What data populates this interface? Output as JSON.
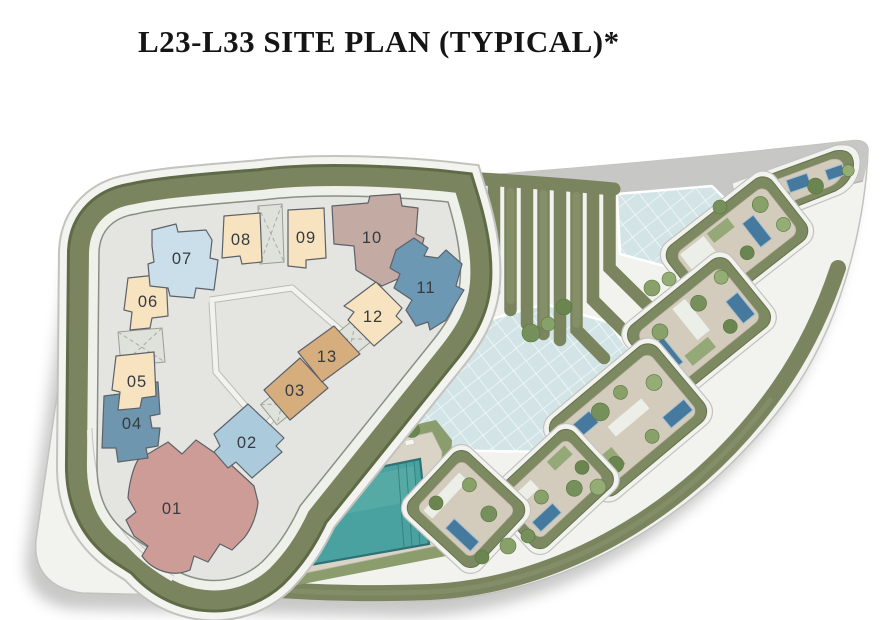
{
  "title": "L23-L33 SITE PLAN (TYPICAL)*",
  "units": [
    {
      "id": "unit-01",
      "label": "01",
      "color": "#cd9c97"
    },
    {
      "id": "unit-02",
      "label": "02",
      "color": "#abcbdc"
    },
    {
      "id": "unit-03",
      "label": "03",
      "color": "#d6ad7c"
    },
    {
      "id": "unit-04",
      "label": "04",
      "color": "#6e96ae"
    },
    {
      "id": "unit-05",
      "label": "05",
      "color": "#f7e3bf"
    },
    {
      "id": "unit-06",
      "label": "06",
      "color": "#f7e3bf"
    },
    {
      "id": "unit-07",
      "label": "07",
      "color": "#cadfe9"
    },
    {
      "id": "unit-08",
      "label": "08",
      "color": "#f7e3bf"
    },
    {
      "id": "unit-09",
      "label": "09",
      "color": "#f7e3bf"
    },
    {
      "id": "unit-10",
      "label": "10",
      "color": "#c3aba3"
    },
    {
      "id": "unit-11",
      "label": "11",
      "color": "#6c98b4"
    },
    {
      "id": "unit-12",
      "label": "12",
      "color": "#f7e3bf"
    },
    {
      "id": "unit-13",
      "label": "13",
      "color": "#d6ad7c"
    }
  ],
  "palette": {
    "hedge": "#7a8560",
    "hedge_dark": "#606b48",
    "building_plate": "#e4e5e0",
    "plate_outline": "#8b8e85",
    "rim": "#f2f2ef",
    "rim_line": "#c2c3bf",
    "road": "#c7c8c6",
    "skylight_glass": "#d2e4e6",
    "pool_water": "#4aa2a0",
    "pool_edge": "#2e7276",
    "pool_deck": "#d9d4c6",
    "villa_court": "#d3cbbb",
    "villa_hedge": "#7c8961",
    "villa_pool": "#46799e",
    "grass": "#94a878",
    "tree_green": "#75905a",
    "unit_label": "#363b41",
    "title_color": "#151515"
  }
}
